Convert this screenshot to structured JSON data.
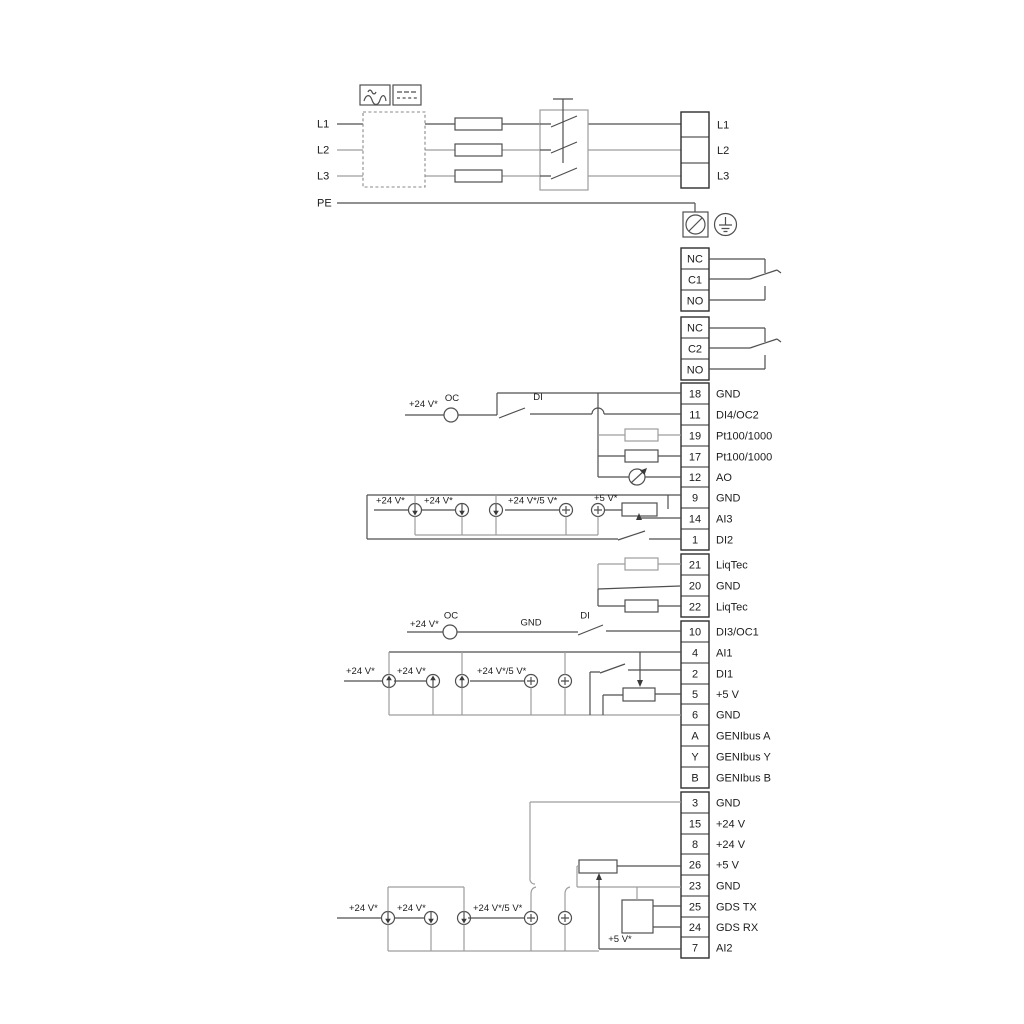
{
  "diagram": {
    "power": {
      "in": [
        "L1",
        "L2",
        "L3",
        "PE"
      ],
      "out": [
        "L1",
        "L2",
        "L3"
      ]
    },
    "relay1": [
      "NC",
      "C1",
      "NO"
    ],
    "relay2": [
      "NC",
      "C2",
      "NO"
    ],
    "block_a": [
      {
        "n": "18",
        "l": "GND"
      },
      {
        "n": "11",
        "l": "DI4/OC2"
      },
      {
        "n": "19",
        "l": "Pt100/1000"
      },
      {
        "n": "17",
        "l": "Pt100/1000"
      },
      {
        "n": "12",
        "l": "AO"
      },
      {
        "n": "9",
        "l": "GND"
      },
      {
        "n": "14",
        "l": "AI3"
      },
      {
        "n": "1",
        "l": "DI2"
      }
    ],
    "block_b": [
      {
        "n": "21",
        "l": "LiqTec"
      },
      {
        "n": "20",
        "l": "GND"
      },
      {
        "n": "22",
        "l": "LiqTec"
      }
    ],
    "block_c": [
      {
        "n": "10",
        "l": "DI3/OC1"
      },
      {
        "n": "4",
        "l": "AI1"
      },
      {
        "n": "2",
        "l": "DI1"
      },
      {
        "n": "5",
        "l": "+5 V"
      },
      {
        "n": "6",
        "l": "GND"
      },
      {
        "n": "A",
        "l": "GENIbus A"
      },
      {
        "n": "Y",
        "l": "GENIbus Y"
      },
      {
        "n": "B",
        "l": "GENIbus B"
      }
    ],
    "block_d": [
      {
        "n": "3",
        "l": "GND"
      },
      {
        "n": "15",
        "l": "+24 V"
      },
      {
        "n": "8",
        "l": "+24 V"
      },
      {
        "n": "26",
        "l": "+5 V"
      },
      {
        "n": "23",
        "l": "GND"
      },
      {
        "n": "25",
        "l": "GDS TX"
      },
      {
        "n": "24",
        "l": "GDS RX"
      },
      {
        "n": "7",
        "l": "AI2"
      }
    ],
    "ann": {
      "v24": "+24 V*",
      "v24v5": "+24 V*/5 V*",
      "v5": "+5 V*",
      "oc": "OC",
      "di": "DI",
      "gnd": "GND"
    }
  }
}
